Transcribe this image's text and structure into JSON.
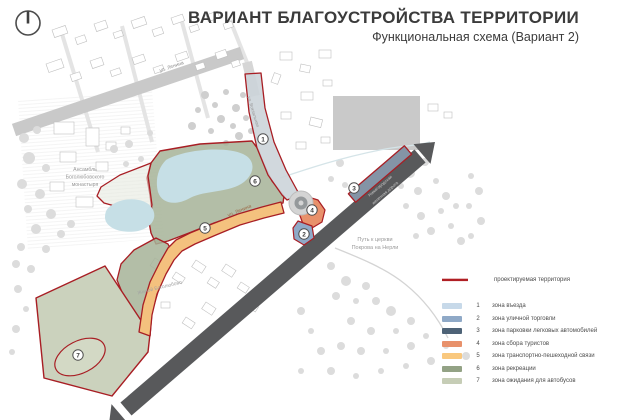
{
  "header": {
    "title": "ВАРИАНТ БЛАГОУСТРОЙСТВА ТЕРРИТОРИИ",
    "subtitle": "Функциональная схема (Вариант 2)"
  },
  "map": {
    "labels": {
      "monastery": [
        "Ансамбль",
        "Боголюбовского",
        "монастыря"
      ],
      "church_path": [
        "Путь к церкви",
        "Покрова на Нерли"
      ],
      "street_top": "ул. Ленина",
      "street_path": "ул. Ленина",
      "street_vertical": "ул. Вокзальная",
      "railway": [
        "Нижегородская",
        "железная дорога"
      ],
      "residential": "Жилой Боголюбово"
    },
    "markers": [
      "1",
      "2",
      "3",
      "4",
      "5",
      "6",
      "7"
    ]
  },
  "legend": {
    "boundary": {
      "label": "проектируемая территория",
      "color": "#b01f24"
    },
    "items": [
      {
        "num": "1",
        "label": "зона въезда",
        "color": "#c7d9e9"
      },
      {
        "num": "2",
        "label": "зона уличной торговли",
        "color": "#8fa9c7"
      },
      {
        "num": "3",
        "label": "зона парковки легковых автомобилей",
        "color": "#4e6377"
      },
      {
        "num": "4",
        "label": "зона сбора туристов",
        "color": "#e8916b"
      },
      {
        "num": "5",
        "label": "зона транспортно-пешеходной связи",
        "color": "#f9c87e"
      },
      {
        "num": "6",
        "label": "зона рекреации",
        "color": "#93a285"
      },
      {
        "num": "7",
        "label": "зона ожидания для автобусов",
        "color": "#c6cdb6"
      }
    ]
  }
}
